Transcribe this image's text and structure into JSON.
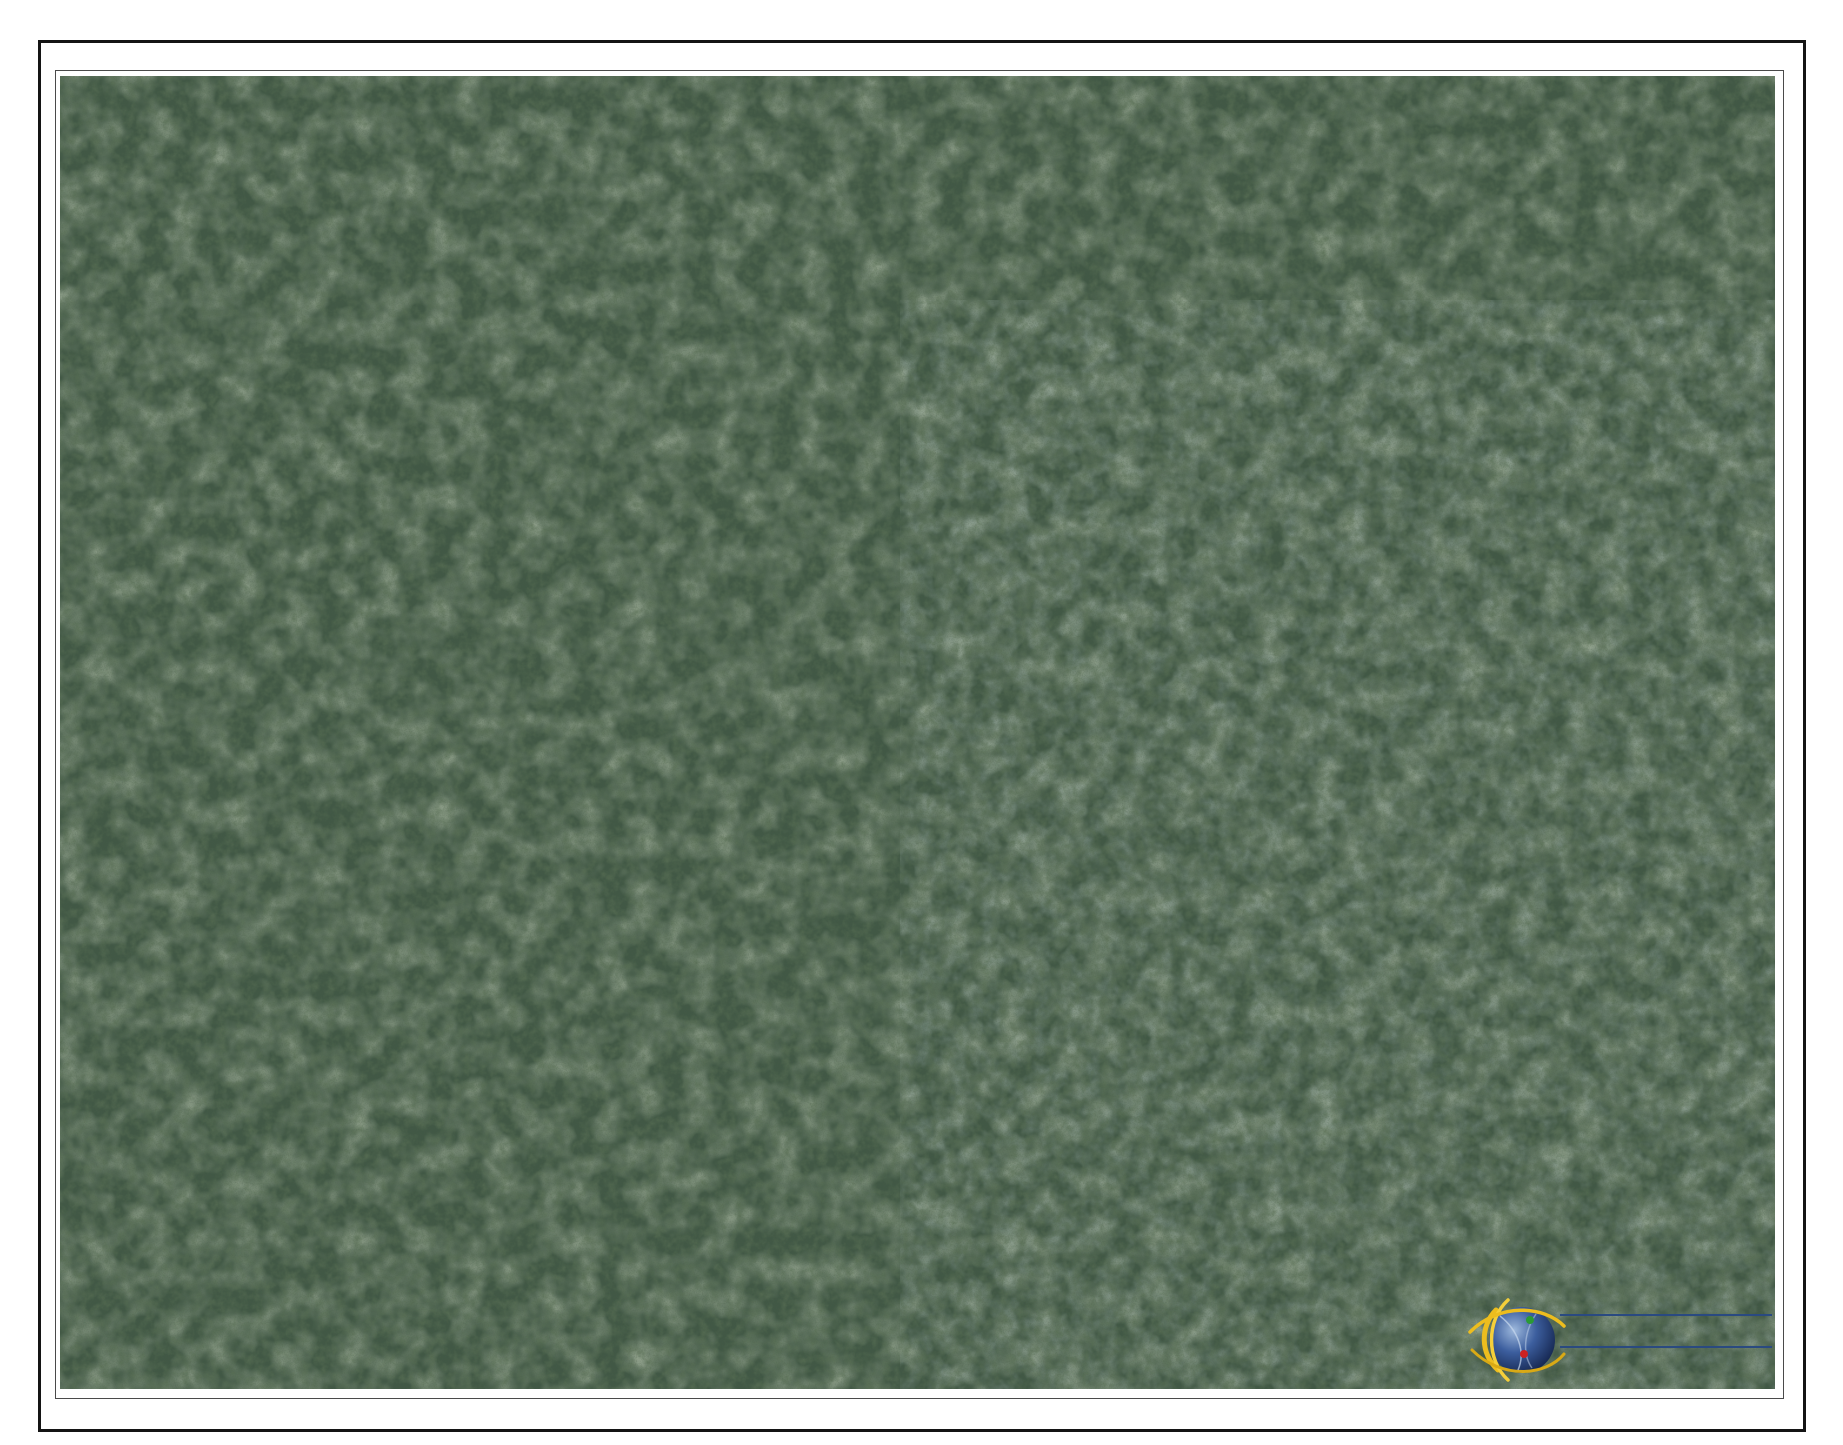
{
  "timestamp": "3/26/26 12:24 PM",
  "watermark": {
    "text": "cireba"
  },
  "logo": {
    "title": "CAYMAN LAND INFO",
    "url": "www.caymanlandinfo.ky"
  },
  "colors": {
    "highlight_parcel_line": "#1717dd",
    "context_parcel_line": "#5c8fdd",
    "label_text": "#4d5888",
    "track_dots": "#f2dcc6",
    "road_centerline": "#cc2a2a",
    "road_fill": "#ffffff"
  },
  "subdivision": {
    "rows": [
      {
        "name": "row-northwest",
        "t0": -48,
        "t1": 48,
        "start": -48,
        "step": 96,
        "lots": [
          "71A254",
          "71A253",
          "71A252",
          "71A251",
          "71A250",
          "71A249",
          "71A248",
          "71A247",
          "71A246",
          "71A245",
          "71A244",
          "71A243",
          "71A242"
        ]
      },
      {
        "name": "row-mid-north",
        "t0": 95,
        "t1": 197,
        "start": 53,
        "step": 102,
        "lots": [
          "71A241",
          "71A240",
          "71A239",
          "71A238",
          "71A237",
          "71A236",
          "71A235",
          "71A234",
          "71A233",
          "71A232",
          "71A231",
          "71A230"
        ]
      },
      {
        "name": "row-mid-south",
        "t0": 197,
        "t1": 299,
        "start": 39,
        "step": 102,
        "lots": [
          "71A229",
          "71A228",
          "71A227",
          "71A226",
          "71A225",
          "71A224",
          "71A223",
          "71A222",
          "71A221",
          "71A220",
          "71A219",
          "71A218"
        ]
      },
      {
        "name": "row-southeast",
        "t0": 345,
        "t1": 451,
        "start": 470,
        "step": 112,
        "lots": [
          "71A211",
          "71A212",
          "71A213",
          "71A214",
          "71A215"
        ]
      }
    ]
  },
  "labels": [
    {
      "id": "71A242",
      "x": 1258,
      "y": 196,
      "type": "subdivision"
    },
    {
      "id": "71A243",
      "x": 1197,
      "y": 265,
      "type": "subdivision"
    },
    {
      "id": "71A244",
      "x": 1135,
      "y": 340,
      "type": "subdivision"
    },
    {
      "id": "71A245",
      "x": 1071,
      "y": 409,
      "type": "subdivision"
    },
    {
      "id": "71A246",
      "x": 1011,
      "y": 484,
      "type": "subdivision"
    },
    {
      "id": "71A247",
      "x": 944,
      "y": 559,
      "type": "subdivision"
    },
    {
      "id": "71A248",
      "x": 873,
      "y": 630,
      "type": "subdivision"
    },
    {
      "id": "71A249",
      "x": 798,
      "y": 680,
      "type": "subdivision"
    },
    {
      "id": "71A250",
      "x": 725,
      "y": 743,
      "type": "subdivision"
    },
    {
      "id": "71A251",
      "x": 657,
      "y": 818,
      "type": "subdivision"
    },
    {
      "id": "71A252",
      "x": 585,
      "y": 898,
      "type": "subdivision"
    },
    {
      "id": "71A253",
      "x": 530,
      "y": 939,
      "type": "subdivision"
    },
    {
      "id": "71A254",
      "x": 456,
      "y": 1005,
      "type": "subdivision"
    },
    {
      "id": "71A230",
      "x": 1404,
      "y": 227,
      "type": "subdivision"
    },
    {
      "id": "71A231",
      "x": 1345,
      "y": 312,
      "type": "subdivision"
    },
    {
      "id": "71A232",
      "x": 1280,
      "y": 393,
      "type": "subdivision"
    },
    {
      "id": "71A233",
      "x": 1207,
      "y": 477,
      "type": "subdivision"
    },
    {
      "id": "71A234",
      "x": 1147,
      "y": 553,
      "type": "subdivision"
    },
    {
      "id": "71A235",
      "x": 1083,
      "y": 627,
      "type": "subdivision"
    },
    {
      "id": "71A236",
      "x": 1020,
      "y": 680,
      "type": "subdivision"
    },
    {
      "id": "71A237",
      "x": 953,
      "y": 752,
      "type": "subdivision"
    },
    {
      "id": "71A238",
      "x": 868,
      "y": 825,
      "type": "subdivision"
    },
    {
      "id": "71A239",
      "x": 794,
      "y": 911,
      "type": "subdivision"
    },
    {
      "id": "71A240",
      "x": 697,
      "y": 967,
      "type": "subdivision"
    },
    {
      "id": "71A241",
      "x": 632,
      "y": 1037,
      "type": "subdivision"
    },
    {
      "id": "71A218",
      "x": 1488,
      "y": 312,
      "type": "subdivision"
    },
    {
      "id": "71A219",
      "x": 1429,
      "y": 388,
      "type": "subdivision"
    },
    {
      "id": "71A220",
      "x": 1371,
      "y": 466,
      "type": "subdivision"
    },
    {
      "id": "71A221",
      "x": 1295,
      "y": 555,
      "type": "subdivision"
    },
    {
      "id": "71A222",
      "x": 1226,
      "y": 626,
      "type": "subdivision"
    },
    {
      "id": "71A223",
      "x": 1169,
      "y": 688,
      "type": "subdivision"
    },
    {
      "id": "71A224",
      "x": 1100,
      "y": 767,
      "type": "subdivision"
    },
    {
      "id": "71A225",
      "x": 1029,
      "y": 850,
      "type": "subdivision"
    },
    {
      "id": "71A226",
      "x": 941,
      "y": 914,
      "type": "subdivision"
    },
    {
      "id": "71A227",
      "x": 865,
      "y": 950,
      "type": "subdivision"
    },
    {
      "id": "71A228",
      "x": 775,
      "y": 1048,
      "type": "subdivision"
    },
    {
      "id": "71A229",
      "x": 705,
      "y": 1130,
      "type": "subdivision"
    },
    {
      "id": "71A211",
      "x": 1118,
      "y": 958,
      "type": "subdivision"
    },
    {
      "id": "71A212",
      "x": 1203,
      "y": 839,
      "type": "subdivision"
    },
    {
      "id": "71A213",
      "x": 1280,
      "y": 758,
      "type": "subdivision"
    },
    {
      "id": "71A214",
      "x": 1350,
      "y": 686,
      "type": "subdivision"
    },
    {
      "id": "71A215",
      "x": 1408,
      "y": 617,
      "type": "subdivision"
    },
    {
      "id": "71A41",
      "x": 116,
      "y": 90,
      "type": "context"
    },
    {
      "id": "71A40",
      "x": 694,
      "y": 267,
      "type": "context"
    },
    {
      "id": "71A256",
      "x": 446,
      "y": 522,
      "type": "context"
    },
    {
      "id": "75A47",
      "x": 1658,
      "y": 748,
      "type": "context"
    },
    {
      "id": "71A217",
      "x": 1550,
      "y": 436,
      "type": "context"
    },
    {
      "id": "71A216",
      "x": 1468,
      "y": 551,
      "type": "context"
    },
    {
      "id": "71A185",
      "x": 383,
      "y": 1063,
      "type": "context"
    },
    {
      "id": "71A184",
      "x": 299,
      "y": 1119,
      "type": "context"
    },
    {
      "id": "71A182",
      "x": 105,
      "y": 1165,
      "type": "context"
    },
    {
      "id": "71A183",
      "x": 215,
      "y": 1165,
      "type": "context"
    },
    {
      "id": "71A172",
      "x": 636,
      "y": 1186,
      "type": "context"
    },
    {
      "id": "71A171",
      "x": 563,
      "y": 1250,
      "type": "context"
    },
    {
      "id": "71A170",
      "x": 507,
      "y": 1333,
      "type": "context"
    },
    {
      "id": "71A164",
      "x": 766,
      "y": 1263,
      "type": "context"
    },
    {
      "id": "71A37",
      "x": 939,
      "y": 1297,
      "type": "context"
    },
    {
      "id": "71A132",
      "x": 933,
      "y": 1095,
      "type": "context"
    },
    {
      "id": "71A188",
      "x": 1375,
      "y": 1115,
      "type": "context"
    }
  ],
  "roads": [
    {
      "name": "access-road-west",
      "points": [
        [
          55,
          1278
        ],
        [
          160,
          1238
        ],
        [
          280,
          1188
        ],
        [
          380,
          1143
        ],
        [
          480,
          1062
        ],
        [
          557,
          1000
        ],
        [
          572,
          988
        ]
      ]
    },
    {
      "name": "access-road-south",
      "points": [
        [
          818,
          1112
        ],
        [
          762,
          1152
        ],
        [
          700,
          1205
        ],
        [
          640,
          1255
        ],
        [
          560,
          1315
        ],
        [
          482,
          1389
        ]
      ]
    }
  ],
  "tracks": [
    {
      "name": "central-track",
      "points": [
        [
          572,
          988
        ],
        [
          649,
          921
        ],
        [
          719,
          848
        ],
        [
          789,
          777
        ],
        [
          859,
          705
        ],
        [
          929,
          634
        ],
        [
          999,
          562
        ],
        [
          1069,
          490
        ],
        [
          1139,
          419
        ],
        [
          1209,
          347
        ],
        [
          1279,
          276
        ],
        [
          1334,
          222
        ]
      ]
    },
    {
      "name": "northeast-loop",
      "points": [
        [
          1334,
          222
        ],
        [
          1372,
          188
        ],
        [
          1412,
          164
        ],
        [
          1460,
          207
        ],
        [
          1497,
          257
        ],
        [
          1528,
          322
        ],
        [
          1520,
          392
        ],
        [
          1470,
          450
        ]
      ]
    },
    {
      "name": "southeast-track",
      "points": [
        [
          1470,
          450
        ],
        [
          1387,
          523
        ],
        [
          1317,
          595
        ],
        [
          1247,
          666
        ],
        [
          1177,
          738
        ],
        [
          1107,
          809
        ],
        [
          1037,
          881
        ],
        [
          967,
          952
        ],
        [
          897,
          1024
        ],
        [
          827,
          1095
        ],
        [
          818,
          1112
        ]
      ]
    },
    {
      "name": "forest-trail",
      "points": [
        [
          432,
          128
        ],
        [
          470,
          240
        ],
        [
          505,
          340
        ],
        [
          472,
          442
        ],
        [
          432,
          548
        ],
        [
          416,
          652
        ],
        [
          436,
          762
        ],
        [
          466,
          862
        ],
        [
          506,
          936
        ],
        [
          545,
          985
        ],
        [
          572,
          988
        ]
      ]
    }
  ],
  "context_boundaries": [
    {
      "name": "parcel-41-edge",
      "points": [
        [
          60,
          158
        ],
        [
          290,
          75
        ]
      ]
    },
    {
      "name": "parcel-40-west",
      "points": [
        [
          440,
          75
        ],
        [
          672,
          440
        ],
        [
          752,
          468
        ]
      ]
    },
    {
      "name": "parcel-40-east",
      "points": [
        [
          705,
          75
        ],
        [
          866,
          348
        ],
        [
          752,
          468
        ]
      ]
    },
    {
      "name": "northeast-corner-a",
      "points": [
        [
          1323,
          90
        ],
        [
          1437,
          172
        ]
      ]
    },
    {
      "name": "northeast-corner-b",
      "points": [
        [
          1540,
          75
        ],
        [
          1460,
          152
        ],
        [
          1377,
          207
        ]
      ]
    },
    {
      "name": "east-long-boundary",
      "points": [
        [
          1437,
          172
        ],
        [
          1462,
          470
        ],
        [
          1447,
          652
        ],
        [
          1507,
          798
        ],
        [
          1553,
          880
        ],
        [
          1608,
          985
        ],
        [
          1625,
          1013
        ],
        [
          1647,
          1060
        ],
        [
          1647,
          1103
        ],
        [
          1673,
          1143
        ],
        [
          1695,
          1205
        ],
        [
          1705,
          1290
        ],
        [
          1707,
          1390
        ]
      ]
    },
    {
      "name": "northeast-to-edge",
      "points": [
        [
          1495,
          75
        ],
        [
          1557,
          170
        ],
        [
          1650,
          260
        ],
        [
          1733,
          337
        ],
        [
          1775,
          378
        ]
      ]
    },
    {
      "name": "east-diagonal",
      "points": [
        [
          1462,
          470
        ],
        [
          1600,
          612
        ],
        [
          1775,
          782
        ]
      ]
    },
    {
      "name": "strip-back-line",
      "points": [
        [
          62,
          1094
        ],
        [
          205,
          1062
        ],
        [
          331,
          1030
        ],
        [
          446,
          999
        ]
      ]
    },
    {
      "name": "strip-divider-1",
      "points": [
        [
          158,
          1098
        ],
        [
          186,
          1208
        ]
      ]
    },
    {
      "name": "strip-divider-2",
      "points": [
        [
          252,
          1076
        ],
        [
          282,
          1185
        ]
      ]
    },
    {
      "name": "strip-divider-3",
      "points": [
        [
          349,
          1051
        ],
        [
          378,
          1158
        ]
      ]
    },
    {
      "name": "strip-divider-4",
      "points": [
        [
          446,
          999
        ],
        [
          470,
          1125
        ]
      ]
    },
    {
      "name": "strip-west-edge",
      "points": [
        [
          68,
          1094
        ],
        [
          68,
          1190
        ]
      ]
    },
    {
      "name": "fan-line-1",
      "points": [
        [
          130,
          1298
        ],
        [
          100,
          1389
        ]
      ]
    },
    {
      "name": "fan-line-2",
      "points": [
        [
          230,
          1260
        ],
        [
          205,
          1389
        ]
      ]
    },
    {
      "name": "fan-line-3",
      "points": [
        [
          330,
          1222
        ],
        [
          308,
          1389
        ]
      ]
    },
    {
      "name": "fan-line-4",
      "points": [
        [
          430,
          1185
        ],
        [
          420,
          1389
        ]
      ]
    },
    {
      "name": "low-cross-line",
      "points": [
        [
          62,
          1302
        ],
        [
          190,
          1338
        ],
        [
          320,
          1372
        ],
        [
          420,
          1389
        ]
      ]
    },
    {
      "name": "lot171-divider",
      "points": [
        [
          500,
          1170
        ],
        [
          420,
          1262
        ]
      ]
    },
    {
      "name": "lot170-divider",
      "points": [
        [
          450,
          1270
        ],
        [
          585,
          1387
        ]
      ]
    },
    {
      "name": "lot164-west",
      "points": [
        [
          618,
          1270
        ],
        [
          704,
          1389
        ]
      ]
    },
    {
      "name": "lot164-northeast",
      "points": [
        [
          825,
          1288
        ],
        [
          905,
          1205
        ],
        [
          952,
          1138
        ]
      ]
    },
    {
      "name": "lot37-132-divider",
      "points": [
        [
          905,
          1205
        ],
        [
          1005,
          1389
        ]
      ]
    },
    {
      "name": "lot188-southwest",
      "points": [
        [
          1035,
          1185
        ],
        [
          1143,
          1375
        ],
        [
          1165,
          1389
        ]
      ]
    },
    {
      "name": "lot216-cell",
      "points": [
        [
          1495,
          480
        ],
        [
          1570,
          560
        ],
        [
          1495,
          640
        ],
        [
          1420,
          560
        ],
        [
          1495,
          480
        ]
      ]
    },
    {
      "name": "lot217-cell",
      "points": [
        [
          1560,
          350
        ],
        [
          1635,
          430
        ],
        [
          1560,
          510
        ],
        [
          1485,
          430
        ],
        [
          1560,
          350
        ]
      ]
    }
  ],
  "extras": {
    "power-line": [
      [
        1498,
        790
      ],
      [
        1498,
        1202
      ]
    ]
  }
}
